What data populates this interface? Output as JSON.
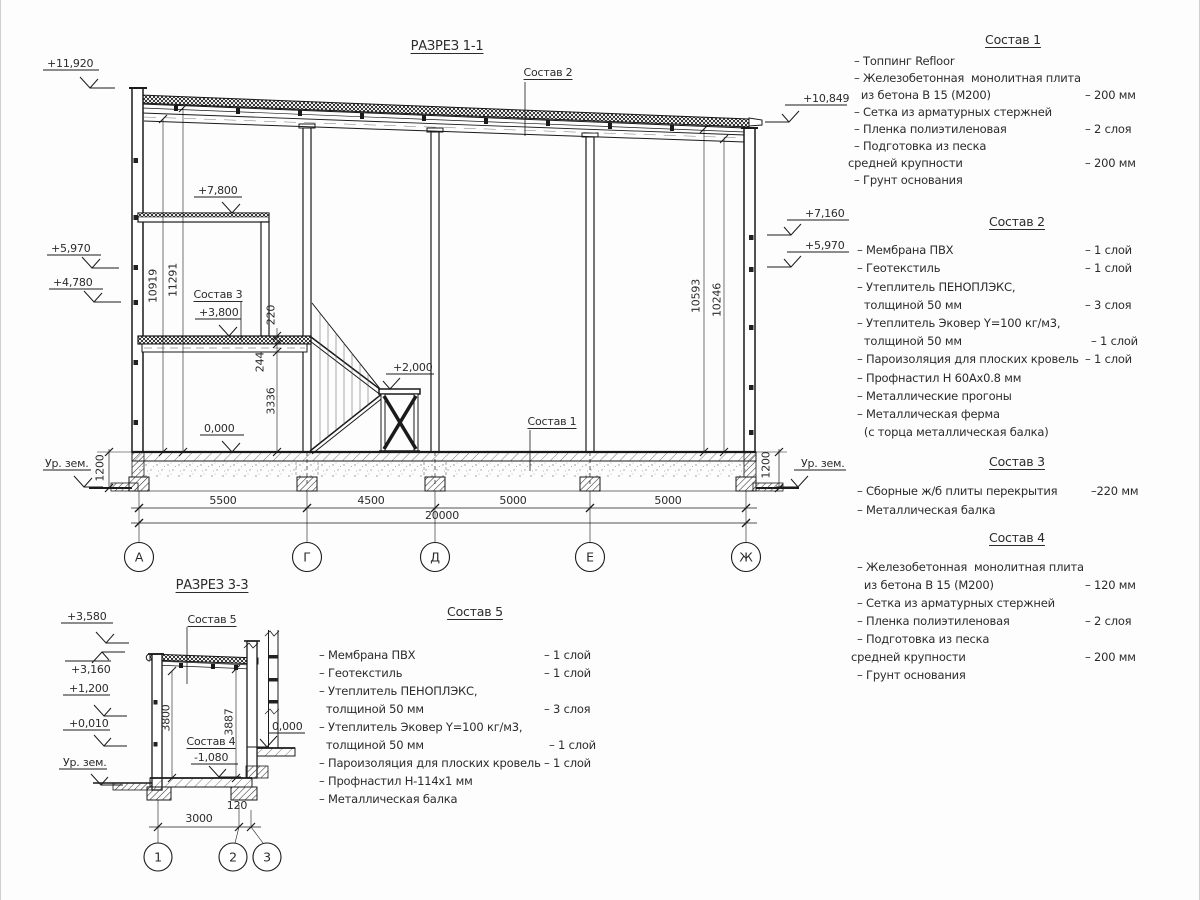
{
  "section1": {
    "title": "РАЗРЕЗ 1-1",
    "callouts": {
      "roof": "Состав 2",
      "floor": "Состав 1",
      "mezzanine": "Состав 3"
    },
    "elevations": {
      "left_top": "+11,920",
      "left_5970": "+5,970",
      "left_4780": "+4,780",
      "mezz_7800": "+7,800",
      "mezz_3800": "+3,800",
      "landing_2000": "+2,000",
      "floor_zero": "0,000",
      "right_top": "+10,849",
      "right_7160": "+7,160",
      "right_5970": "+5,970",
      "ground_left": "Ур. зем.",
      "ground_right": "Ур. зем."
    },
    "vertical_dims": {
      "left_inner": "10919",
      "left_outer": "11291",
      "right_inner": "10593",
      "right_outer": "10246",
      "slab": "220",
      "beam": "244",
      "under_mezz": "3336",
      "ground_left": "1200",
      "ground_right": "1200"
    },
    "horizontal_dims": {
      "a_g": "5500",
      "g_d": "4500",
      "d_e": "5000",
      "e_j": "5000",
      "total": "20000"
    },
    "axes": [
      "А",
      "Г",
      "Д",
      "Е",
      "Ж"
    ]
  },
  "section3": {
    "title": "РАЗРЕЗ 3-3",
    "callouts": {
      "roof": "Состав 5",
      "floor": "Состав 4"
    },
    "elevations": {
      "top": "+3,580",
      "e3160": "+3,160",
      "e1200": "+1,200",
      "e0010": "+0,010",
      "ground": "Ур. зем.",
      "zero": "0,000",
      "pit": "-1,080"
    },
    "vertical_dims": {
      "left": "3800",
      "right": "3887"
    },
    "horizontal_dims": {
      "span": "3000",
      "offset": "120"
    },
    "axes": [
      "1",
      "2",
      "3"
    ]
  },
  "compositions": [
    {
      "title": "Состав 1",
      "rows": [
        {
          "l": "– Топпинг Refloor",
          "r": ""
        },
        {
          "l": "– Железобетонная  монолитная плита",
          "r": ""
        },
        {
          "l": "  из бетона В 15 (М200)",
          "r": "– 200 мм"
        },
        {
          "l": "– Сетка из арматурных стержней",
          "r": ""
        },
        {
          "l": "– Пленка полиэтиленовая",
          "r": "– 2 слоя"
        },
        {
          "l": "– Подготовка из песка",
          "r": ""
        },
        {
          "l": "средней крупности",
          "r": "– 200 мм"
        },
        {
          "l": "– Грунт основания",
          "r": ""
        }
      ]
    },
    {
      "title": "Состав 2",
      "rows": [
        {
          "l": "– Мембрана ПВХ",
          "r": "– 1 слой"
        },
        {
          "l": "– Геотекстиль",
          "r": "– 1 слой"
        },
        {
          "l": "– Утеплитель ПЕНОПЛЭКС,",
          "r": ""
        },
        {
          "l": "  толщиной 50 мм",
          "r": "– 3 слоя"
        },
        {
          "l": "– Утеплитель Эковер Y=100 кг/м3,",
          "r": ""
        },
        {
          "l": "  толщиной 50 мм",
          "r": "– 1 слой"
        },
        {
          "l": "– Пароизоляция для плоских кровель",
          "r": "– 1 слой"
        },
        {
          "l": "– Профнастил Н 60Ах0.8 мм",
          "r": ""
        },
        {
          "l": "– Металлические прогоны",
          "r": ""
        },
        {
          "l": "– Металлическая ферма",
          "r": ""
        },
        {
          "l": "  (с торца металлическая балка)",
          "r": ""
        }
      ]
    },
    {
      "title": "Состав 3",
      "rows": [
        {
          "l": "– Сборные ж/б плиты перекрытия",
          "r": "–220 мм"
        },
        {
          "l": "– Металлическая балка",
          "r": ""
        }
      ]
    },
    {
      "title": "Состав 4",
      "rows": [
        {
          "l": "– Железобетонная  монолитная плита",
          "r": ""
        },
        {
          "l": "  из бетона В 15 (М200)",
          "r": "– 120 мм"
        },
        {
          "l": "– Сетка из арматурных стержней",
          "r": ""
        },
        {
          "l": "– Пленка полиэтиленовая",
          "r": "– 2 слоя"
        },
        {
          "l": "– Подготовка из песка",
          "r": ""
        },
        {
          "l": "средней крупности",
          "r": "– 200 мм"
        },
        {
          "l": "– Грунт основания",
          "r": ""
        }
      ]
    },
    {
      "title": "Состав 5",
      "rows": [
        {
          "l": "– Мембрана ПВХ",
          "r": "– 1 слой"
        },
        {
          "l": "– Геотекстиль",
          "r": "– 1 слой"
        },
        {
          "l": "– Утеплитель ПЕНОПЛЭКС,",
          "r": ""
        },
        {
          "l": "  толщиной 50 мм",
          "r": "– 3 слоя"
        },
        {
          "l": "– Утеплитель Эковер Y=100 кг/м3,",
          "r": ""
        },
        {
          "l": "  толщиной 50 мм",
          "r": "– 1 слой"
        },
        {
          "l": "– Пароизоляция для плоских кровель",
          "r": "– 1 слой"
        },
        {
          "l": "– Профнастил Н-114х1 мм",
          "r": ""
        },
        {
          "l": "– Металлическая балка",
          "r": ""
        }
      ]
    }
  ]
}
